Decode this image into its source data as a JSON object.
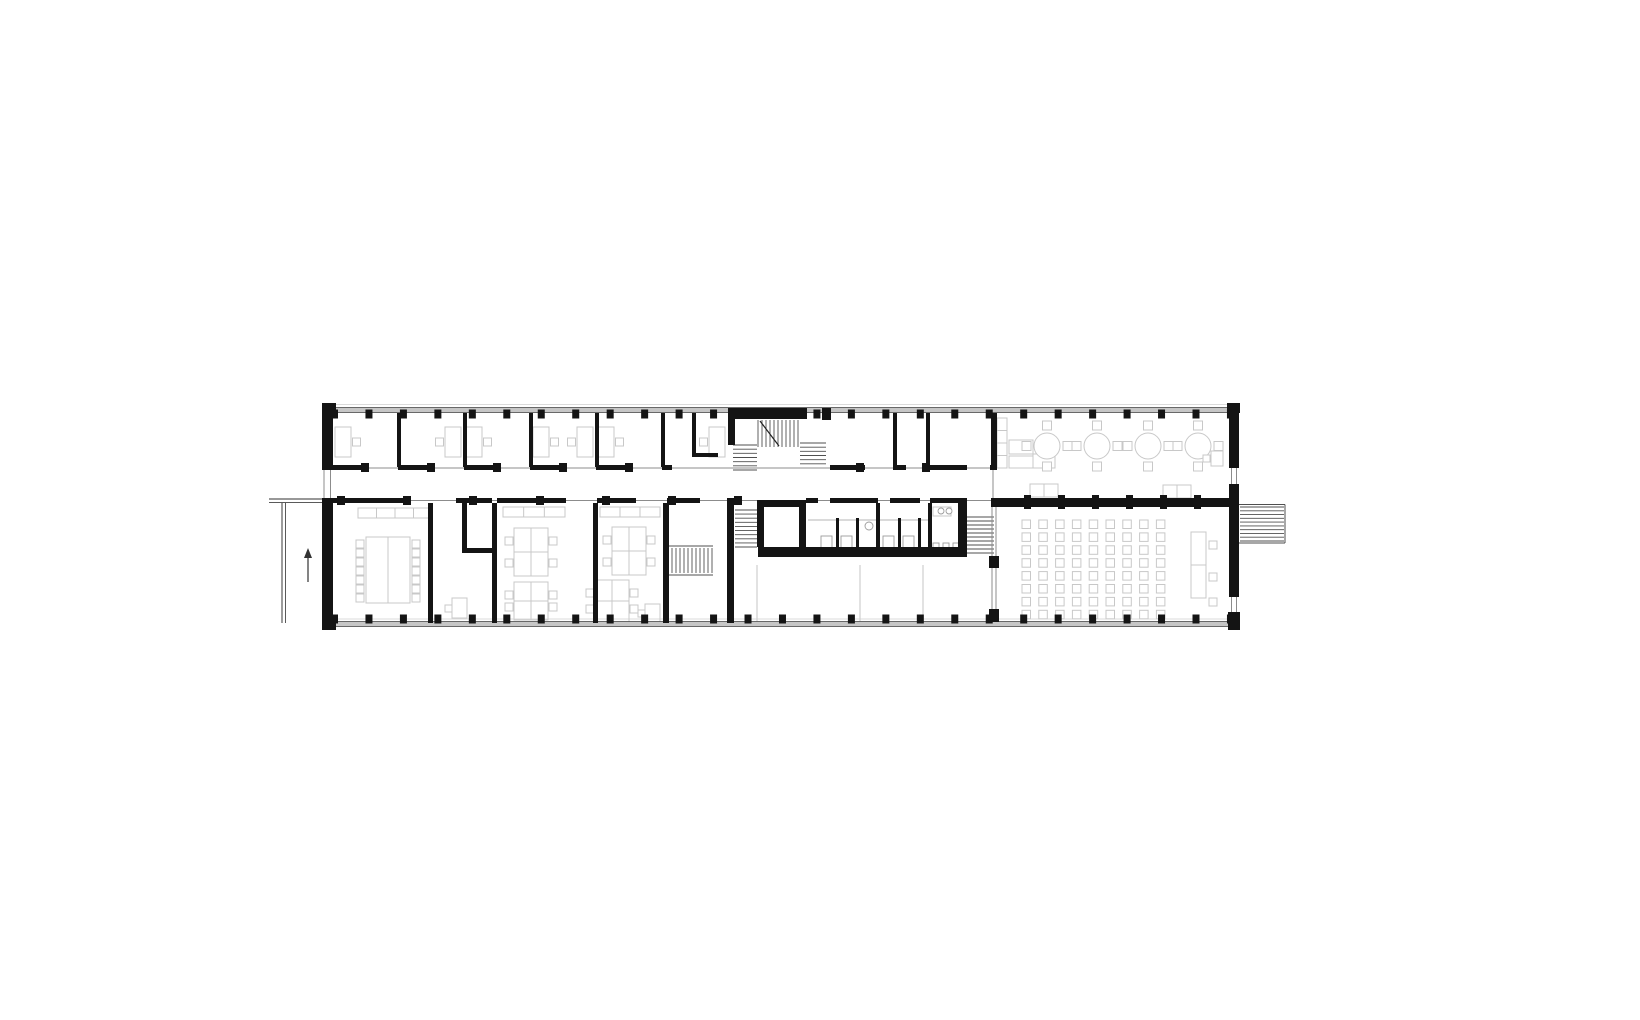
{
  "title": "Architectural floor plan — long two-bay building with central stair core, offices, seminar rooms, WC core, cafeteria and lecture room",
  "canvas": {
    "w": 1640,
    "h": 1020,
    "bg": "#ffffff"
  },
  "colors": {
    "wall": "#141414",
    "glazing_fill": "#c6c6c6",
    "glazing_edge": "#4a4a4a",
    "thin": "#8c8c8c",
    "light": "#cfcfcf",
    "furniture": "#c8c8c8",
    "fixture": "#9c9c9c",
    "tread": "#4f4f4f",
    "path": "#5a5a5a",
    "arrow": "#333333"
  },
  "facade": {
    "bands": [
      {
        "x": 333,
        "y": 407.5,
        "w": 896,
        "h": 5
      },
      {
        "x": 333,
        "y": 621.5,
        "w": 896,
        "h": 5
      }
    ],
    "columns": {
      "x0": 331,
      "step": 34.46,
      "count": 27,
      "w": 7,
      "h": 9,
      "top_y": 409.5,
      "bottom_y": 614.5,
      "top_skip": [
        12,
        13
      ]
    }
  },
  "walls": [
    [
      322,
      403,
      14,
      9
    ],
    [
      1227,
      403,
      13,
      10
    ],
    [
      322,
      410,
      11,
      60
    ],
    [
      322,
      498,
      11,
      132
    ],
    [
      322,
      620,
      14,
      10
    ],
    [
      1229,
      412,
      10,
      56
    ],
    [
      1229,
      484,
      10,
      113
    ],
    [
      1228,
      612,
      12,
      18
    ],
    [
      397,
      413,
      4,
      54
    ],
    [
      463,
      413,
      4,
      54
    ],
    [
      529,
      413,
      4,
      54
    ],
    [
      595,
      413,
      4,
      54
    ],
    [
      661,
      413,
      4,
      54
    ],
    [
      692,
      413,
      4,
      44
    ],
    [
      692,
      453,
      26,
      4
    ],
    [
      728,
      408,
      79,
      11
    ],
    [
      728,
      408,
      7,
      37
    ],
    [
      822,
      408,
      9,
      12
    ],
    [
      893,
      413,
      4,
      54
    ],
    [
      926,
      413,
      4,
      54
    ],
    [
      991,
      413,
      6,
      55
    ],
    [
      333,
      465,
      35,
      5
    ],
    [
      398,
      465,
      36,
      5
    ],
    [
      464,
      465,
      36,
      5
    ],
    [
      530,
      465,
      36,
      5
    ],
    [
      596,
      465,
      36,
      5
    ],
    [
      662,
      465,
      10,
      5
    ],
    [
      830,
      465,
      35,
      5
    ],
    [
      893,
      465,
      13,
      5
    ],
    [
      926,
      465,
      41,
      5
    ],
    [
      990,
      465,
      7,
      5
    ],
    [
      333,
      498,
      71,
      5
    ],
    [
      456,
      498,
      36,
      5
    ],
    [
      497,
      498,
      69,
      5
    ],
    [
      597,
      498,
      39,
      5
    ],
    [
      667,
      498,
      33,
      5
    ],
    [
      727,
      498,
      8,
      5
    ],
    [
      806,
      498,
      12,
      5
    ],
    [
      830,
      498,
      48,
      5
    ],
    [
      890,
      498,
      30,
      5
    ],
    [
      930,
      498,
      37,
      5
    ],
    [
      991,
      498,
      238,
      9
    ],
    [
      428,
      503,
      5,
      120
    ],
    [
      492,
      503,
      5,
      120
    ],
    [
      593,
      503,
      5,
      120
    ],
    [
      663,
      503,
      6,
      120
    ],
    [
      727,
      498,
      7,
      125
    ],
    [
      462,
      503,
      5,
      50
    ],
    [
      462,
      548,
      35,
      5
    ],
    [
      989,
      556,
      10,
      12
    ],
    [
      989,
      609,
      10,
      13
    ],
    [
      757,
      500,
      7,
      47
    ],
    [
      799,
      500,
      7,
      47
    ],
    [
      757,
      500,
      49,
      7
    ],
    [
      758,
      547,
      209,
      10
    ],
    [
      876,
      503,
      4,
      44
    ],
    [
      928,
      503,
      4,
      44
    ],
    [
      958,
      498,
      9,
      49
    ],
    [
      836,
      518,
      3,
      29
    ],
    [
      856,
      518,
      3,
      29
    ],
    [
      898,
      518,
      3,
      29
    ],
    [
      918,
      518,
      3,
      29
    ]
  ],
  "wall_squares": [
    [
      361,
      463,
      8,
      9
    ],
    [
      427,
      463,
      8,
      9
    ],
    [
      493,
      463,
      8,
      9
    ],
    [
      559,
      463,
      8,
      9
    ],
    [
      625,
      463,
      8,
      9
    ],
    [
      856,
      463,
      8,
      9
    ],
    [
      922,
      463,
      8,
      9
    ],
    [
      337,
      496,
      8,
      9
    ],
    [
      403,
      496,
      8,
      9
    ],
    [
      469,
      496,
      8,
      9
    ],
    [
      536,
      496,
      8,
      9
    ],
    [
      602,
      496,
      8,
      9
    ],
    [
      668,
      496,
      8,
      9
    ],
    [
      734,
      496,
      8,
      9
    ],
    [
      1024,
      495,
      7,
      14
    ],
    [
      1058,
      495,
      7,
      14
    ],
    [
      1092,
      495,
      7,
      14
    ],
    [
      1126,
      495,
      7,
      14
    ],
    [
      1160,
      495,
      7,
      14
    ],
    [
      1194,
      495,
      7,
      14
    ]
  ],
  "thin_lines": [
    [
      333,
      404.5,
      1229,
      404.5,
      0.8,
      "light"
    ],
    [
      333,
      619,
      1229,
      619,
      0.8,
      "light"
    ],
    [
      333,
      468,
      991,
      468,
      1,
      "thin"
    ],
    [
      333,
      500.5,
      991,
      500.5,
      1,
      "thin"
    ],
    [
      324,
      470,
      324,
      498,
      1,
      "thin"
    ],
    [
      330.5,
      470,
      330.5,
      498,
      1,
      "thin"
    ],
    [
      1231.5,
      468,
      1231.5,
      484,
      1,
      "thin"
    ],
    [
      1236.5,
      468,
      1236.5,
      484,
      1,
      "thin"
    ],
    [
      1231.5,
      597,
      1231.5,
      612,
      1,
      "thin"
    ],
    [
      1236.5,
      597,
      1236.5,
      612,
      1,
      "thin"
    ],
    [
      269,
      499,
      322,
      499,
      1.2,
      "path"
    ],
    [
      269,
      502.5,
      322,
      502.5,
      1,
      "path"
    ],
    [
      282,
      503,
      282,
      623,
      1.2,
      "path"
    ],
    [
      285.5,
      503,
      285.5,
      623,
      1,
      "path"
    ],
    [
      993,
      470,
      993,
      498,
      1,
      "thin"
    ],
    [
      992,
      507,
      992,
      623,
      1,
      "thin"
    ],
    [
      996,
      507,
      996,
      623,
      1,
      "thin"
    ],
    [
      666,
      546,
      713,
      546,
      1,
      "tread"
    ],
    [
      666,
      575,
      713,
      575,
      1,
      "tread"
    ],
    [
      1239,
      504.5,
      1285,
      504.5,
      1,
      "tread"
    ],
    [
      1239,
      543,
      1285,
      543,
      1,
      "tread"
    ],
    [
      1285,
      504.5,
      1285,
      543,
      1,
      "tread"
    ],
    [
      808,
      520,
      876,
      520,
      0.8,
      "fixture"
    ],
    [
      880,
      520,
      928,
      520,
      0.8,
      "fixture"
    ],
    [
      757,
      565,
      757,
      622,
      1.2,
      "light"
    ],
    [
      860,
      565,
      860,
      622,
      1.2,
      "light"
    ],
    [
      923,
      565,
      923,
      622,
      1.2,
      "light"
    ]
  ],
  "stairs": [
    {
      "x": 758,
      "y": 420,
      "w": 40,
      "h": 27,
      "lines": "v",
      "n": 10
    },
    {
      "x": 733,
      "y": 445,
      "w": 24,
      "h": 25,
      "lines": "h",
      "n": 6
    },
    {
      "x": 800,
      "y": 443,
      "w": 26,
      "h": 25,
      "lines": "h",
      "n": 6
    },
    {
      "x": 668,
      "y": 548,
      "w": 44,
      "h": 25,
      "lines": "v",
      "n": 11
    },
    {
      "x": 735,
      "y": 510,
      "w": 22,
      "h": 37,
      "lines": "h",
      "n": 9
    },
    {
      "x": 965,
      "y": 517,
      "w": 29,
      "h": 36,
      "lines": "h",
      "n": 9
    },
    {
      "x": 1240,
      "y": 507,
      "w": 44,
      "h": 34,
      "lines": "h",
      "n": 9
    }
  ],
  "diagonals": [
    [
      760,
      421,
      779,
      446
    ]
  ],
  "furniture": {
    "desks": [
      {
        "pos": [
          335,
          427
        ],
        "chair": "R"
      },
      {
        "pos": [
          445,
          427
        ],
        "chair": "L"
      },
      {
        "pos": [
          466,
          427
        ],
        "chair": "R"
      },
      {
        "pos": [
          533,
          427
        ],
        "chair": "R"
      },
      {
        "pos": [
          577,
          427
        ],
        "chair": "L"
      },
      {
        "pos": [
          598,
          427
        ],
        "chair": "R"
      },
      {
        "pos": [
          709,
          427
        ],
        "chair": "L"
      }
    ],
    "small_desks": [
      {
        "rect": [
          452,
          598,
          15,
          20
        ],
        "chair": [
          445,
          605
        ]
      },
      {
        "rect": [
          645,
          604,
          15,
          19
        ],
        "chair": [
          638,
          610
        ]
      }
    ],
    "sideboards": [
      {
        "x": 358,
        "y": 508,
        "w": 74,
        "h": 10,
        "div": 3
      },
      {
        "x": 503,
        "y": 507,
        "w": 62,
        "h": 10,
        "div": 2
      },
      {
        "x": 600,
        "y": 507,
        "w": 60,
        "h": 10,
        "div": 2
      },
      {
        "x": 997,
        "y": 418,
        "w": 10,
        "h": 50,
        "div": 3
      }
    ],
    "conference": {
      "table": [
        366,
        537,
        44,
        66
      ],
      "chair_ys": [
        540,
        549,
        558,
        567,
        576,
        585,
        594
      ],
      "left_x": 356,
      "right_x": 412
    },
    "clusters": [
      {
        "x": 514,
        "y": 528,
        "w": 34,
        "h": 48
      },
      {
        "x": 514,
        "y": 582,
        "w": 34,
        "h": 38
      },
      {
        "x": 612,
        "y": 527,
        "w": 34,
        "h": 48
      },
      {
        "x": 595,
        "y": 580,
        "w": 34,
        "h": 42
      }
    ],
    "counters": [
      [
        1009,
        440,
        24,
        14
      ],
      [
        1009,
        456,
        24,
        12
      ],
      [
        1033,
        454,
        22,
        14
      ],
      [
        933,
        507,
        18,
        9
      ]
    ],
    "round_tables": {
      "centers": [
        [
          1047,
          446
        ],
        [
          1097,
          446
        ],
        [
          1148,
          446
        ],
        [
          1198,
          446
        ]
      ],
      "r": 13,
      "chair": 9,
      "gap": 22.5
    },
    "low_tables": [
      [
        1030,
        484,
        28,
        13
      ],
      [
        1163,
        485,
        28,
        13
      ]
    ],
    "wall_table": {
      "rect": [
        1211,
        451,
        12,
        15
      ],
      "chair": [
        1203,
        455
      ]
    },
    "lecture_grid": {
      "x0": 1022,
      "y0": 520,
      "dx": 16.8,
      "dy": 12.9,
      "cols": 9,
      "rows": 8,
      "s": 8.5
    },
    "lecturer_tables": [
      [
        1191,
        532,
        15,
        33
      ],
      [
        1191,
        565,
        15,
        33
      ]
    ],
    "lecturer_chairs": [
      [
        1209,
        541
      ],
      [
        1209,
        573
      ],
      [
        1209,
        598
      ]
    ],
    "toilets": [
      [
        821,
        536,
        11,
        13
      ],
      [
        841,
        536,
        11,
        13
      ],
      [
        883,
        536,
        11,
        13
      ],
      [
        903,
        536,
        11,
        13
      ]
    ],
    "urinals": [
      [
        933,
        543,
        6,
        8
      ],
      [
        943,
        543,
        6,
        8
      ],
      [
        953,
        543,
        6,
        8
      ]
    ],
    "sinks": [
      [
        869,
        526,
        4
      ],
      [
        941,
        511,
        3
      ],
      [
        949,
        511,
        3
      ]
    ]
  },
  "north_arrow": {
    "shaft": [
      308,
      582,
      308,
      557
    ],
    "head": [
      [
        304,
        558
      ],
      [
        312,
        558
      ],
      [
        308,
        548
      ]
    ]
  }
}
